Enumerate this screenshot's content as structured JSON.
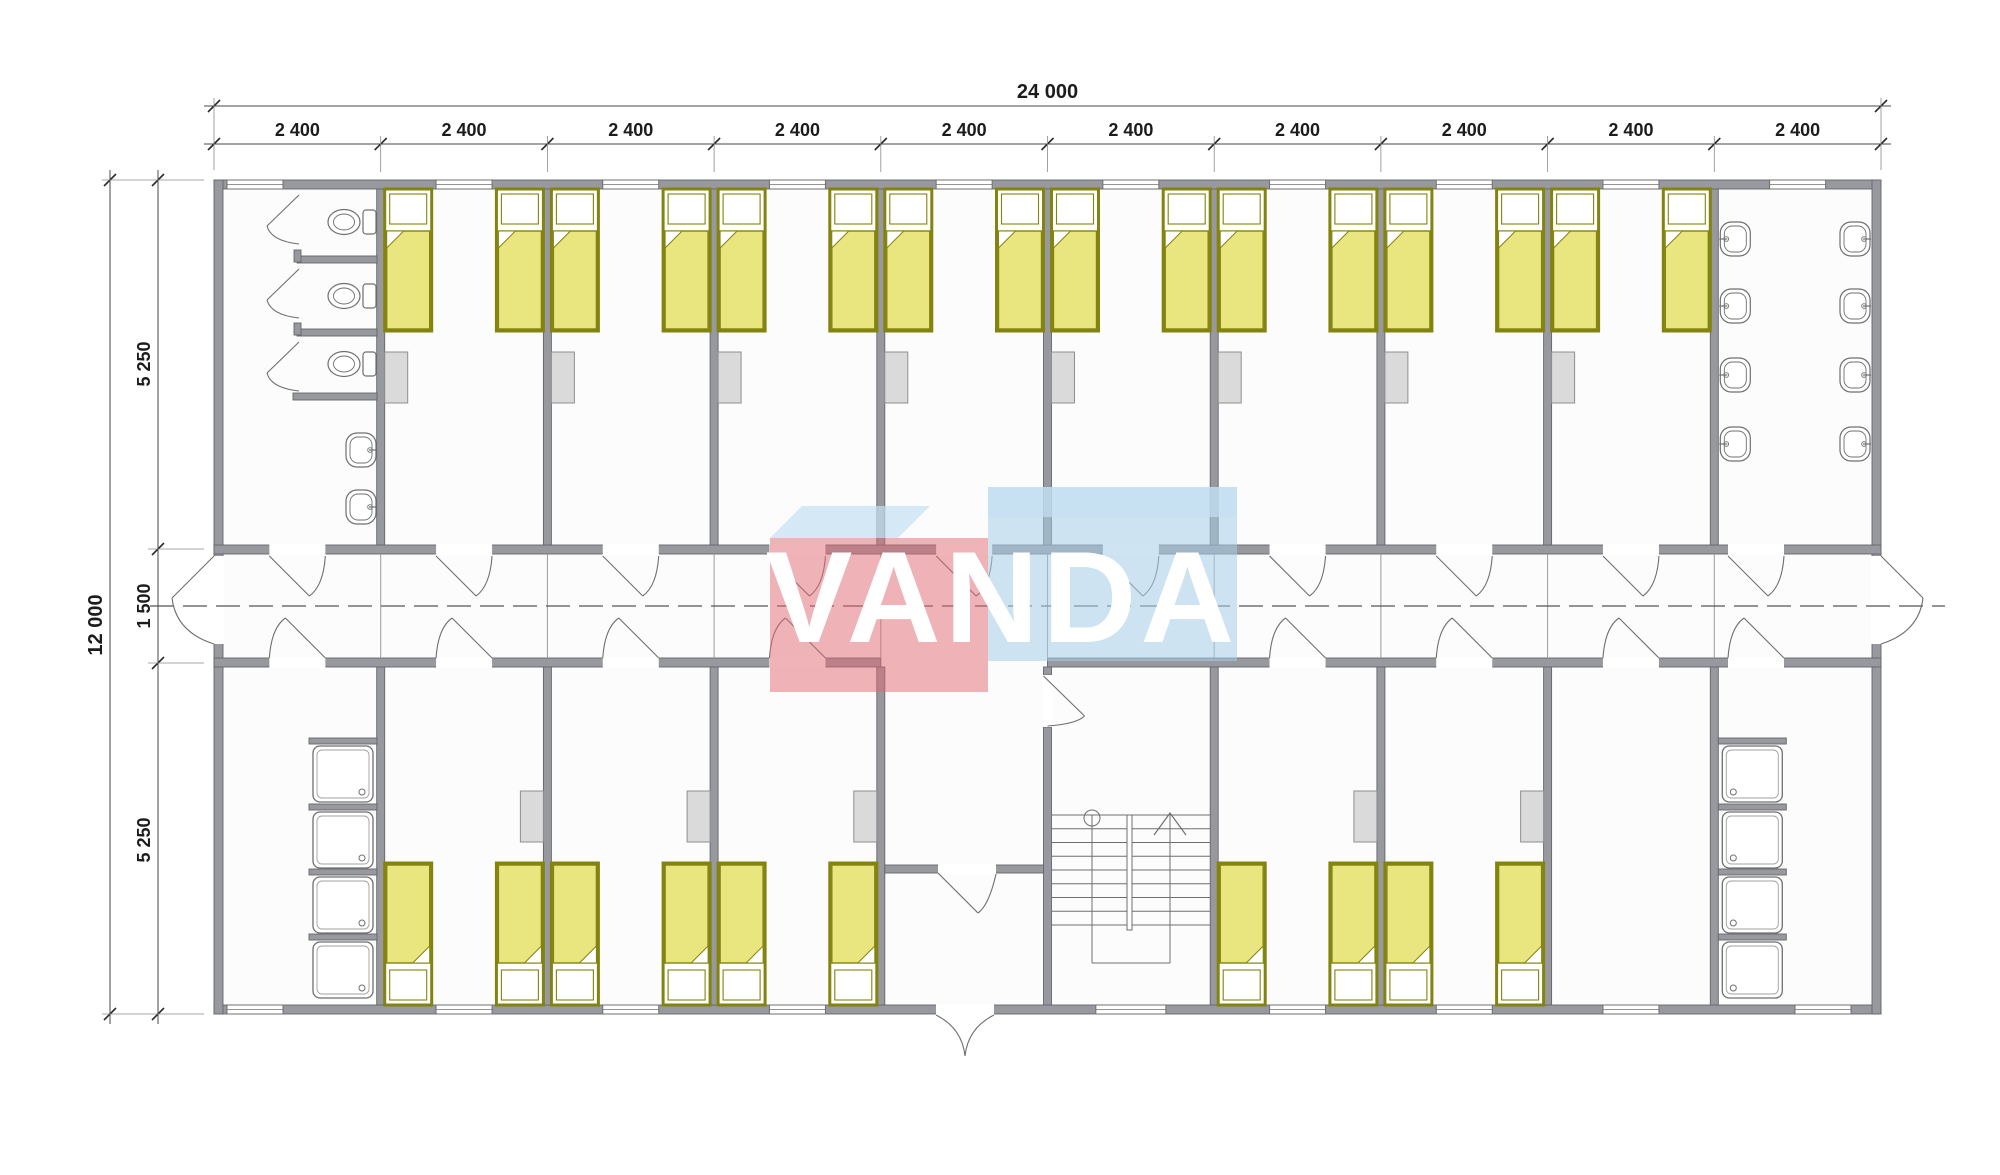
{
  "drawing": {
    "type": "architectural-floor-plan",
    "subject": "modular dormitory building, ground plan with central corridor"
  },
  "watermark": {
    "text": "VANDA"
  },
  "dimensions": {
    "top_total": "24 000",
    "top_modules": [
      "2 400",
      "2 400",
      "2 400",
      "2 400",
      "2 400",
      "2 400",
      "2 400",
      "2 400",
      "2 400",
      "2 400"
    ],
    "left_total": "12 000",
    "left_segments": [
      "5 250",
      "1 500",
      "5 250"
    ]
  },
  "fixtures": {
    "beds": 26,
    "wardrobes": 13,
    "toilets": 3,
    "wash_basins": 10,
    "shower_trays": 8,
    "windows": 19,
    "door_openings": 26,
    "stairs": 1
  },
  "colors": {
    "wall": "#97999e",
    "wall_edge": "#63666b",
    "floor": "#fcfcfc",
    "line": "#6f6f6f",
    "bed_frame": "#83830f",
    "bed_blanket": "#e9e680",
    "locker_fill": "#dadada",
    "locker_edge": "#8f8f8f",
    "dim": "#1c1c1c",
    "watermark_red": "rgba(224,104,114,0.50)",
    "watermark_blue": "rgba(167,205,232,0.55)",
    "watermark_roof": "rgba(196,224,242,0.70)",
    "watermark_text": "#ffffff"
  }
}
